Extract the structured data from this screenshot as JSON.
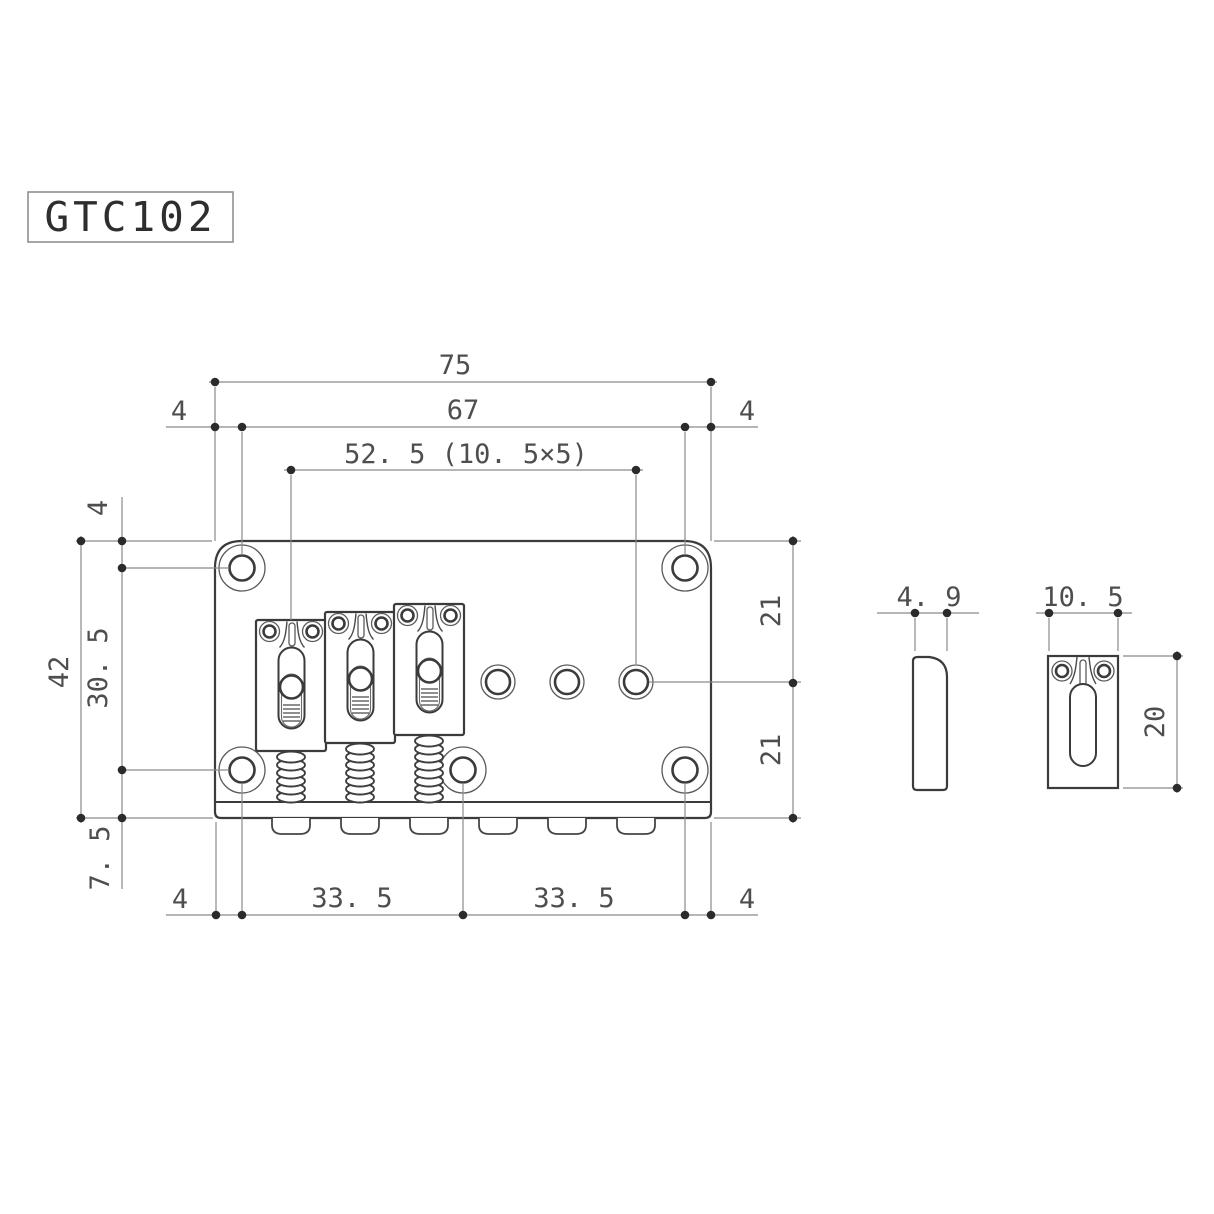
{
  "title": {
    "model_label": "GTC102"
  },
  "main_view": {
    "name": "bridge top view",
    "dims": {
      "overall_width": "75",
      "mount_hole_span_top": "67",
      "string_spread": "52. 5 (10. 5×5)",
      "edge_to_hole_top_left": "4",
      "edge_to_hole_top_right": "4",
      "top_edge_to_hole_row": "4",
      "overall_depth": "42",
      "hole_rows_span": "30. 5",
      "hole_row_to_bottom_edge": "7. 5",
      "edge_to_hole_bottom_left": "4",
      "bottom_hole_span_left": "33. 5",
      "bottom_hole_span_right": "33. 5",
      "edge_to_hole_bottom_right": "4",
      "top_edge_to_string_row": "21",
      "string_row_to_bottom_edge": "21"
    }
  },
  "saddle_side_view": {
    "name": "saddle side profile",
    "dims": {
      "saddle_thickness": "4. 9"
    }
  },
  "saddle_top_view": {
    "name": "saddle top view",
    "dims": {
      "saddle_width": "10. 5",
      "saddle_length": "20"
    }
  }
}
